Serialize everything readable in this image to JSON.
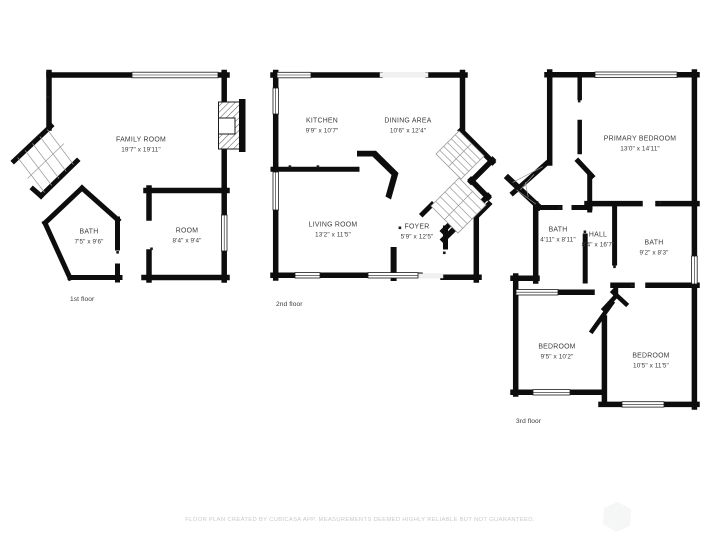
{
  "page": {
    "background": "#ffffff",
    "wall_color": "#0d0d0d",
    "label_color": "#3c3c3c",
    "footer_color": "#c7cacc"
  },
  "floors": [
    {
      "label": "1st floor",
      "rooms": [
        {
          "name": "FAMILY ROOM",
          "dims": "19'7\" x 19'11\""
        },
        {
          "name": "BATH",
          "dims": "7'5\" x 9'6\""
        },
        {
          "name": "ROOM",
          "dims": "8'4\" x 9'4\""
        }
      ]
    },
    {
      "label": "2nd floor",
      "rooms": [
        {
          "name": "KITCHEN",
          "dims": "9'9\" x 10'7\""
        },
        {
          "name": "DINING AREA",
          "dims": "10'6\" x 12'4\""
        },
        {
          "name": "LIVING ROOM",
          "dims": "13'2\" x 11'5\""
        },
        {
          "name": "FOYER",
          "dims": "5'9\" x 12'5\""
        }
      ]
    },
    {
      "label": "3rd floor",
      "rooms": [
        {
          "name": "PRIMARY BEDROOM",
          "dims": "13'0\" x 14'11\""
        },
        {
          "name": "BATH",
          "dims": "4'11\" x 8'11\""
        },
        {
          "name": "HALL",
          "dims": "8'4\" x 16'7\""
        },
        {
          "name": "BATH",
          "dims": "9'2\" x 8'3\""
        },
        {
          "name": "BEDROOM",
          "dims": "9'5\" x 10'2\""
        },
        {
          "name": "BEDROOM",
          "dims": "10'5\" x 11'5\""
        }
      ]
    }
  ],
  "footer": "FLOOR PLAN CREATED BY CUBICASA APP. MEASUREMENTS DEEMED HIGHLY RELIABLE BUT NOT GUARANTEED."
}
